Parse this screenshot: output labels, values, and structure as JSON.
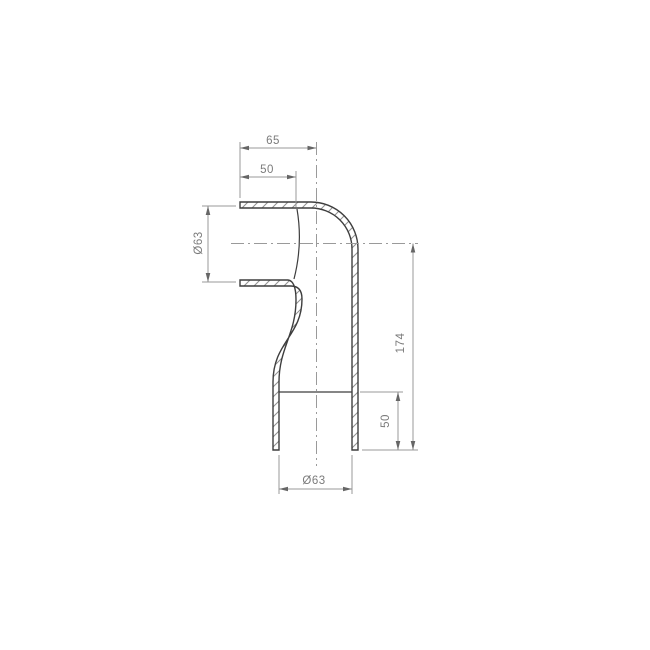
{
  "drawing": {
    "dims": {
      "top_width": "65",
      "top_socket_depth": "50",
      "inlet_diameter": "Ø63",
      "overall_height": "174",
      "bottom_socket_depth": "50",
      "outlet_diameter": "Ø63"
    },
    "colors": {
      "outline": "#3e3e3e",
      "hatch": "#8f8f8f",
      "dimension": "#9a9a9a",
      "arrow": "#666666",
      "label": "#7b7b7b",
      "background": "#ffffff"
    }
  }
}
